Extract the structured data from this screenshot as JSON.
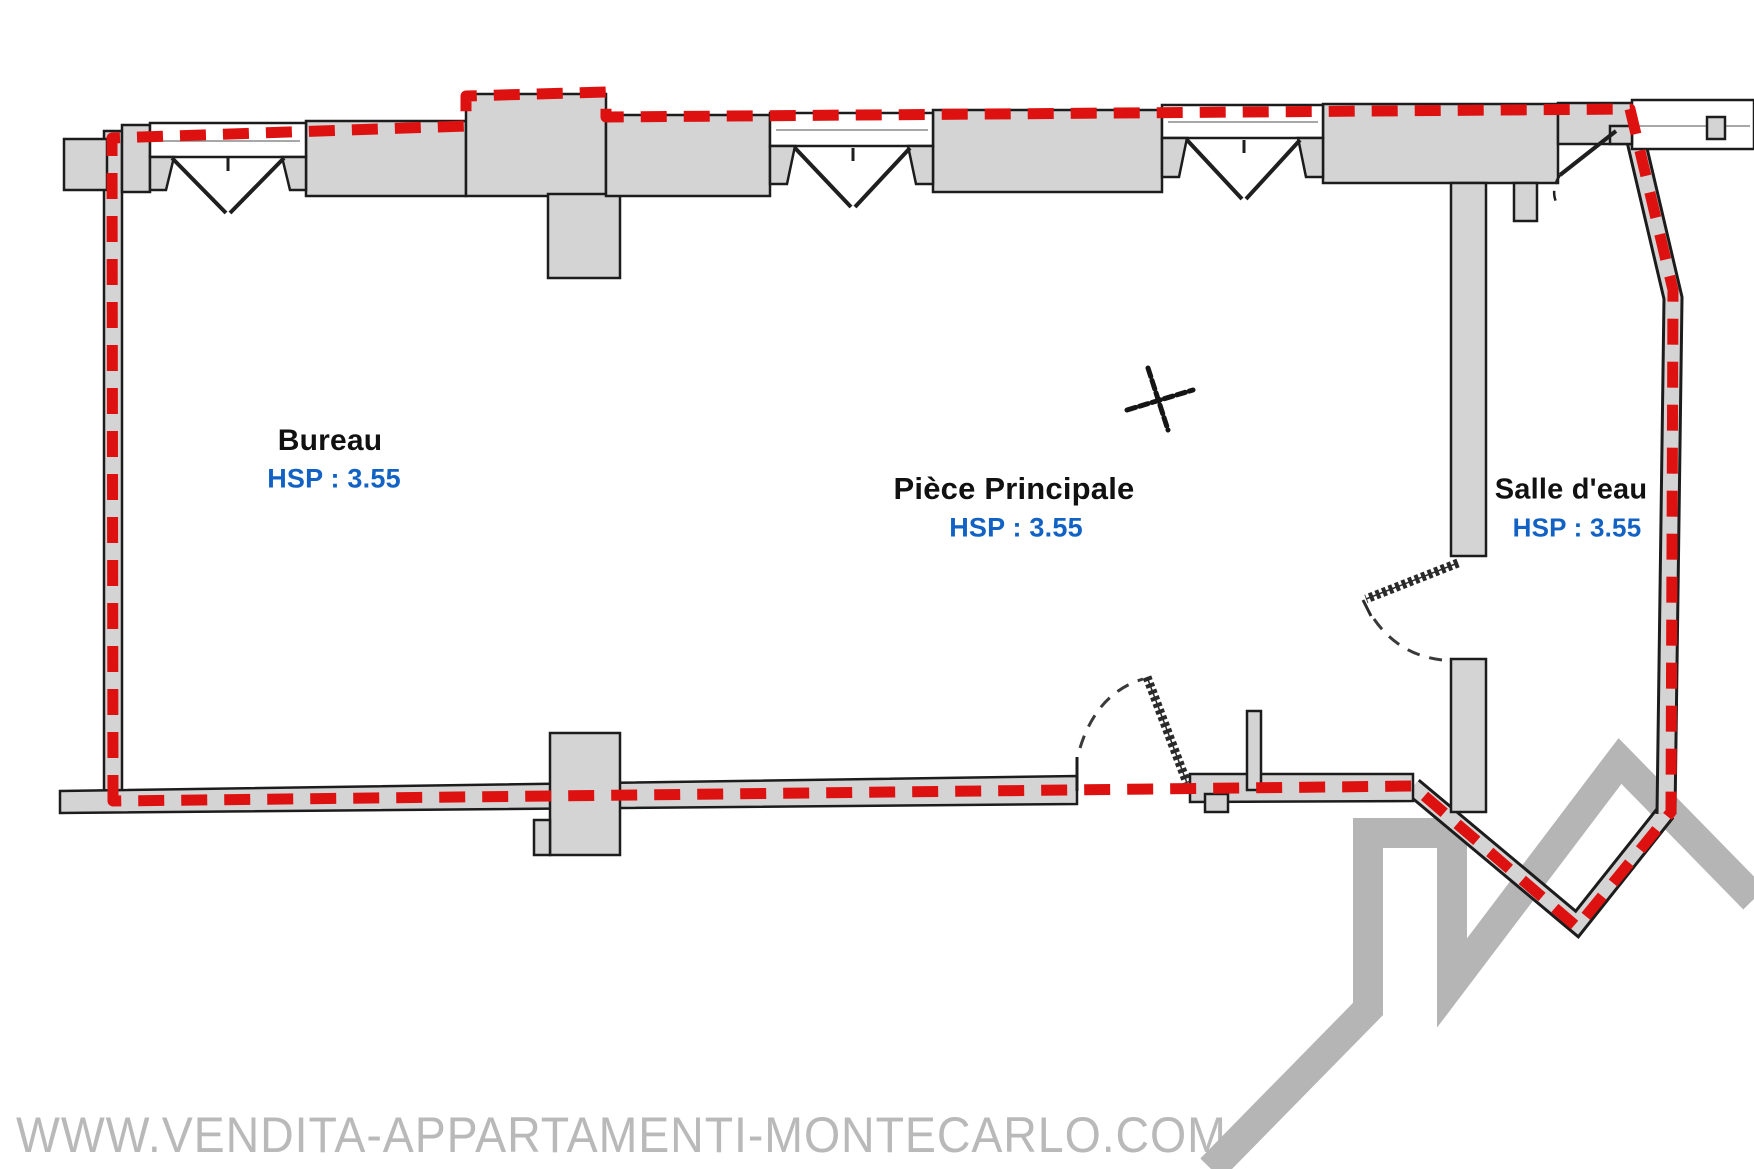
{
  "watermark": {
    "url_text": "WWW.VENDITA-APPARTAMENTI-MONTECARLO.COM"
  },
  "rooms": [
    {
      "name": "Bureau",
      "height_note": "HSP : 3.55"
    },
    {
      "name": "Pièce Principale",
      "height_note": "HSP : 3.55"
    },
    {
      "name": "Salle d'eau",
      "height_note": "HSP : 3.55"
    }
  ],
  "colors": {
    "boundary_red": "#de1111",
    "hsp_blue": "#1162c4",
    "wall_gray": "#d4d4d4",
    "outline_black": "#1c1c1c",
    "logo_gray": "#b5b5b5",
    "watermark_gray": "#b9b9b9"
  }
}
